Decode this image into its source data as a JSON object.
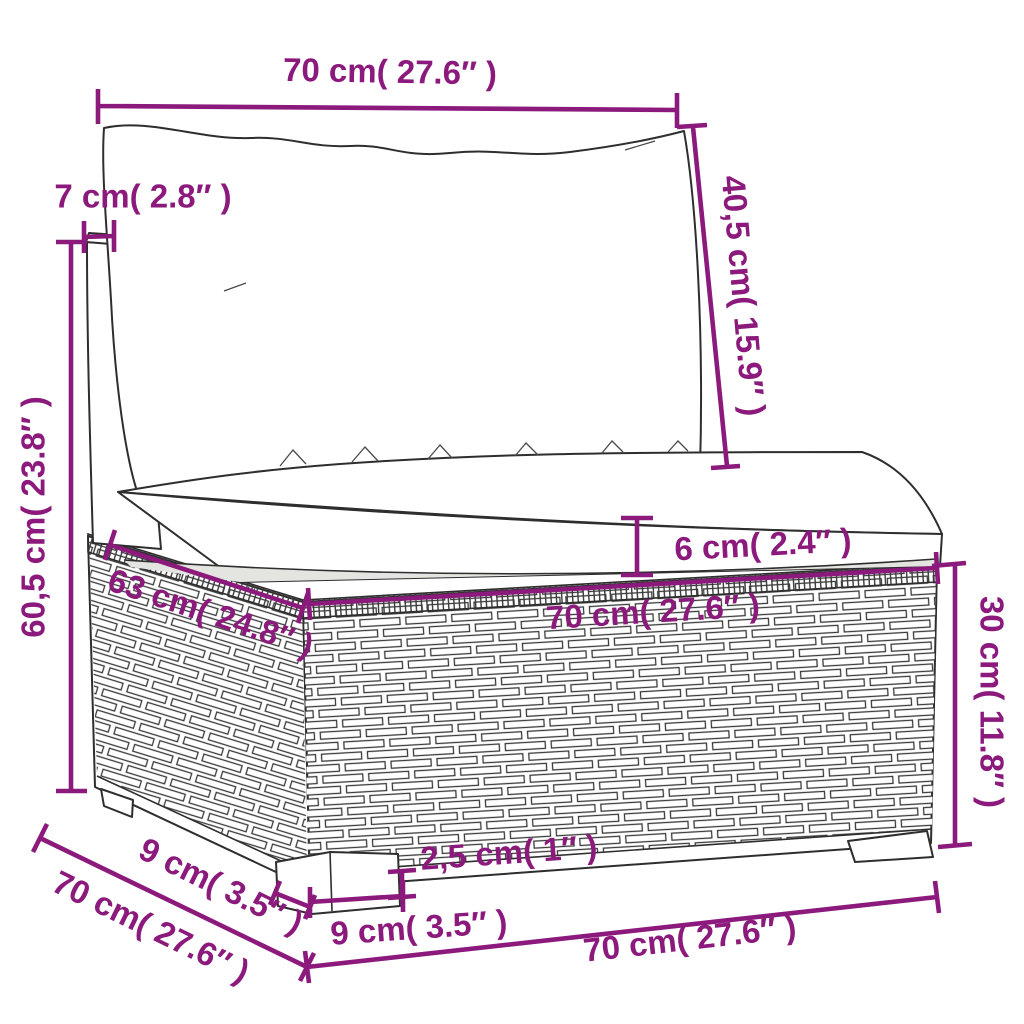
{
  "diagram": {
    "type": "product-dimension-diagram",
    "subject": "poly-rattan-sofa-middle-section-with-cushions",
    "accent_color": "#8B1A7C",
    "line_color": "#2e2e2e",
    "dimensions": {
      "back_cushion_width": "70 cm( 27.6″ )",
      "back_cushion_height": "40,5 cm( 15.9″ )",
      "backrest_thickness": "7 cm( 2.8″ )",
      "back_total_height": "60,5 cm( 23.8″ )",
      "seat_cushion_thickness": "6 cm( 2.4″ )",
      "seat_width": "70 cm( 27.6″ )",
      "seat_depth": "63 cm( 24.8″ )",
      "base_height": "30 cm( 11.8″ )",
      "total_depth": "70 cm( 27.6″ )",
      "leg_depth": "9 cm( 3.5″ )",
      "leg_inset": "2,5 cm( 1″ )",
      "leg_width": "9 cm( 3.5″ )",
      "base_width": "70 cm( 27.6″ )"
    }
  }
}
